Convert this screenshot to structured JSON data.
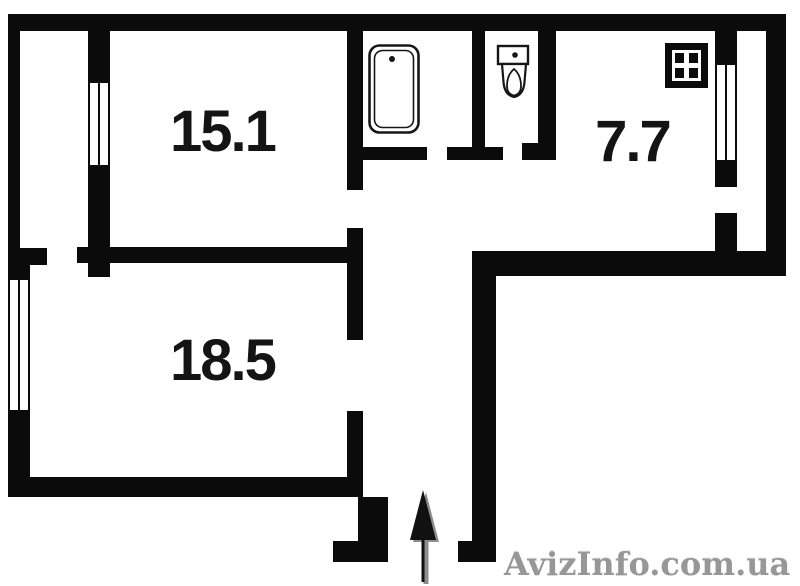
{
  "floorplan": {
    "type": "apartment-floor-plan",
    "rooms": [
      {
        "id": "bedroom",
        "area_label": "15.1"
      },
      {
        "id": "living-room",
        "area_label": "18.5"
      },
      {
        "id": "kitchen",
        "area_label": "7.7"
      }
    ],
    "fixtures": [
      {
        "name": "bathtub-icon",
        "room": "bathroom"
      },
      {
        "name": "toilet-icon",
        "room": "wc"
      },
      {
        "name": "stove-icon",
        "room": "kitchen"
      }
    ],
    "entrance": {
      "marker": "entrance-arrow-icon",
      "direction": "up"
    },
    "windows": [
      "left-wall-window",
      "left-loggia-window",
      "kitchen-window"
    ],
    "watermark": "AvizInfo.com.ua",
    "colors": {
      "wall": "#0b0b0b",
      "label": "#141414",
      "watermark": "#979797"
    }
  }
}
